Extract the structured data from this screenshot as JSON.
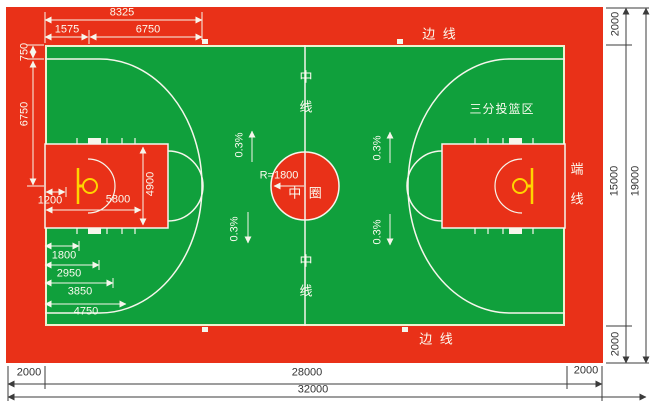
{
  "court": {
    "colors": {
      "surround_red": "#e93118",
      "court_green": "#10a03c",
      "line_white": "#f6f6ec",
      "marking_yellow": "#ffd400",
      "dimension_dark": "#333333"
    },
    "labels": {
      "center_line_top": "中 线",
      "center_line_bottom": "中 线",
      "center_circle": "中 圈",
      "center_circle_radius": "R=1800",
      "sideline_top": "边 线",
      "sideline_bottom": "边 线",
      "endline": "端 线",
      "three_point_area": "三分投篮区"
    },
    "slopes": [
      "0.3%",
      "0.3%",
      "0.3%",
      "0.3%"
    ],
    "dims": {
      "top_8325": "8325",
      "top_1575": "1575",
      "top_6750": "6750",
      "left_750": "750",
      "left_6750": "6750",
      "key_1200": "1200",
      "key_5800": "5800",
      "key_4900": "4900",
      "base_1800": "1800",
      "base_2950": "2950",
      "base_3850": "3850",
      "base_4750": "4750",
      "right_2000_top": "2000",
      "right_15000": "15000",
      "right_19000": "19000",
      "right_2000_bottom": "2000",
      "bottom_2000_left": "2000",
      "bottom_28000": "28000",
      "bottom_2000_right": "2000",
      "bottom_32000": "32000"
    }
  }
}
